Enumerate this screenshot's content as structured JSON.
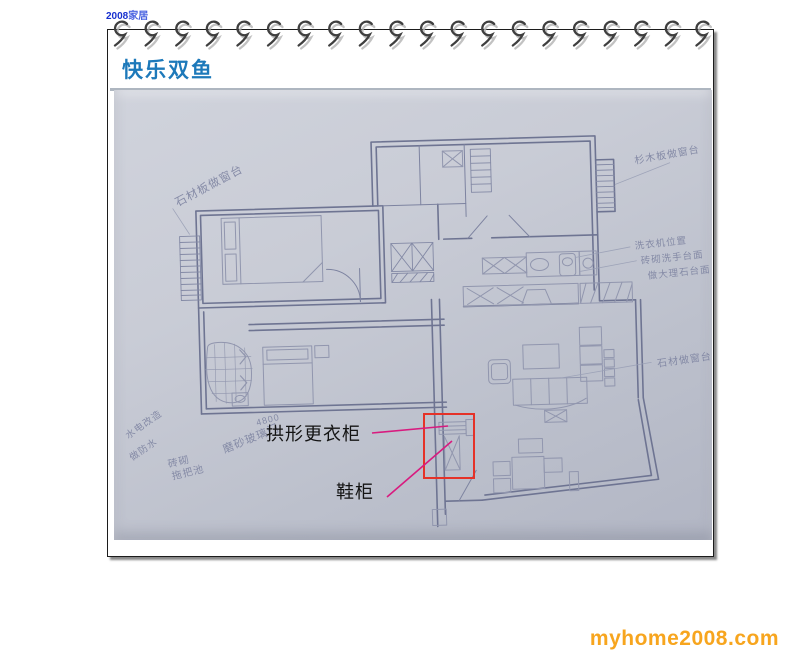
{
  "header": {
    "logo_year": "2008",
    "logo_suffix": "家居",
    "title": "快乐双鱼"
  },
  "footer": {
    "watermark": "myhome2008.com"
  },
  "photo": {
    "kind": "hand-drawn apartment floor plan pencil sketch",
    "red_labels": [
      {
        "text": "拱形更衣柜"
      },
      {
        "text": "鞋柜"
      }
    ],
    "pencil_notes": [
      {
        "text": "石材板做窗台"
      },
      {
        "text": "杉木板做窗台"
      },
      {
        "text": "洗衣机位置"
      },
      {
        "text": "砖砌洗手台面"
      },
      {
        "text": "做大理石台面"
      },
      {
        "text": "石材做窗台"
      },
      {
        "text": "磨砂玻璃门"
      },
      {
        "text": "砖砌"
      },
      {
        "text": "拖把池"
      },
      {
        "text": "水电改造"
      },
      {
        "text": "做防水"
      },
      {
        "text": "4800"
      }
    ]
  },
  "colors": {
    "title_blue": "#1d79ba",
    "logo_blue": "#1730cf",
    "watermark_orange": "#f7a51e",
    "annotation_red": "#e53228",
    "annotation_magenta": "#d81b7f",
    "pencil_gray_blue": "#7c82a0",
    "photo_background": "#c2c6d1"
  }
}
